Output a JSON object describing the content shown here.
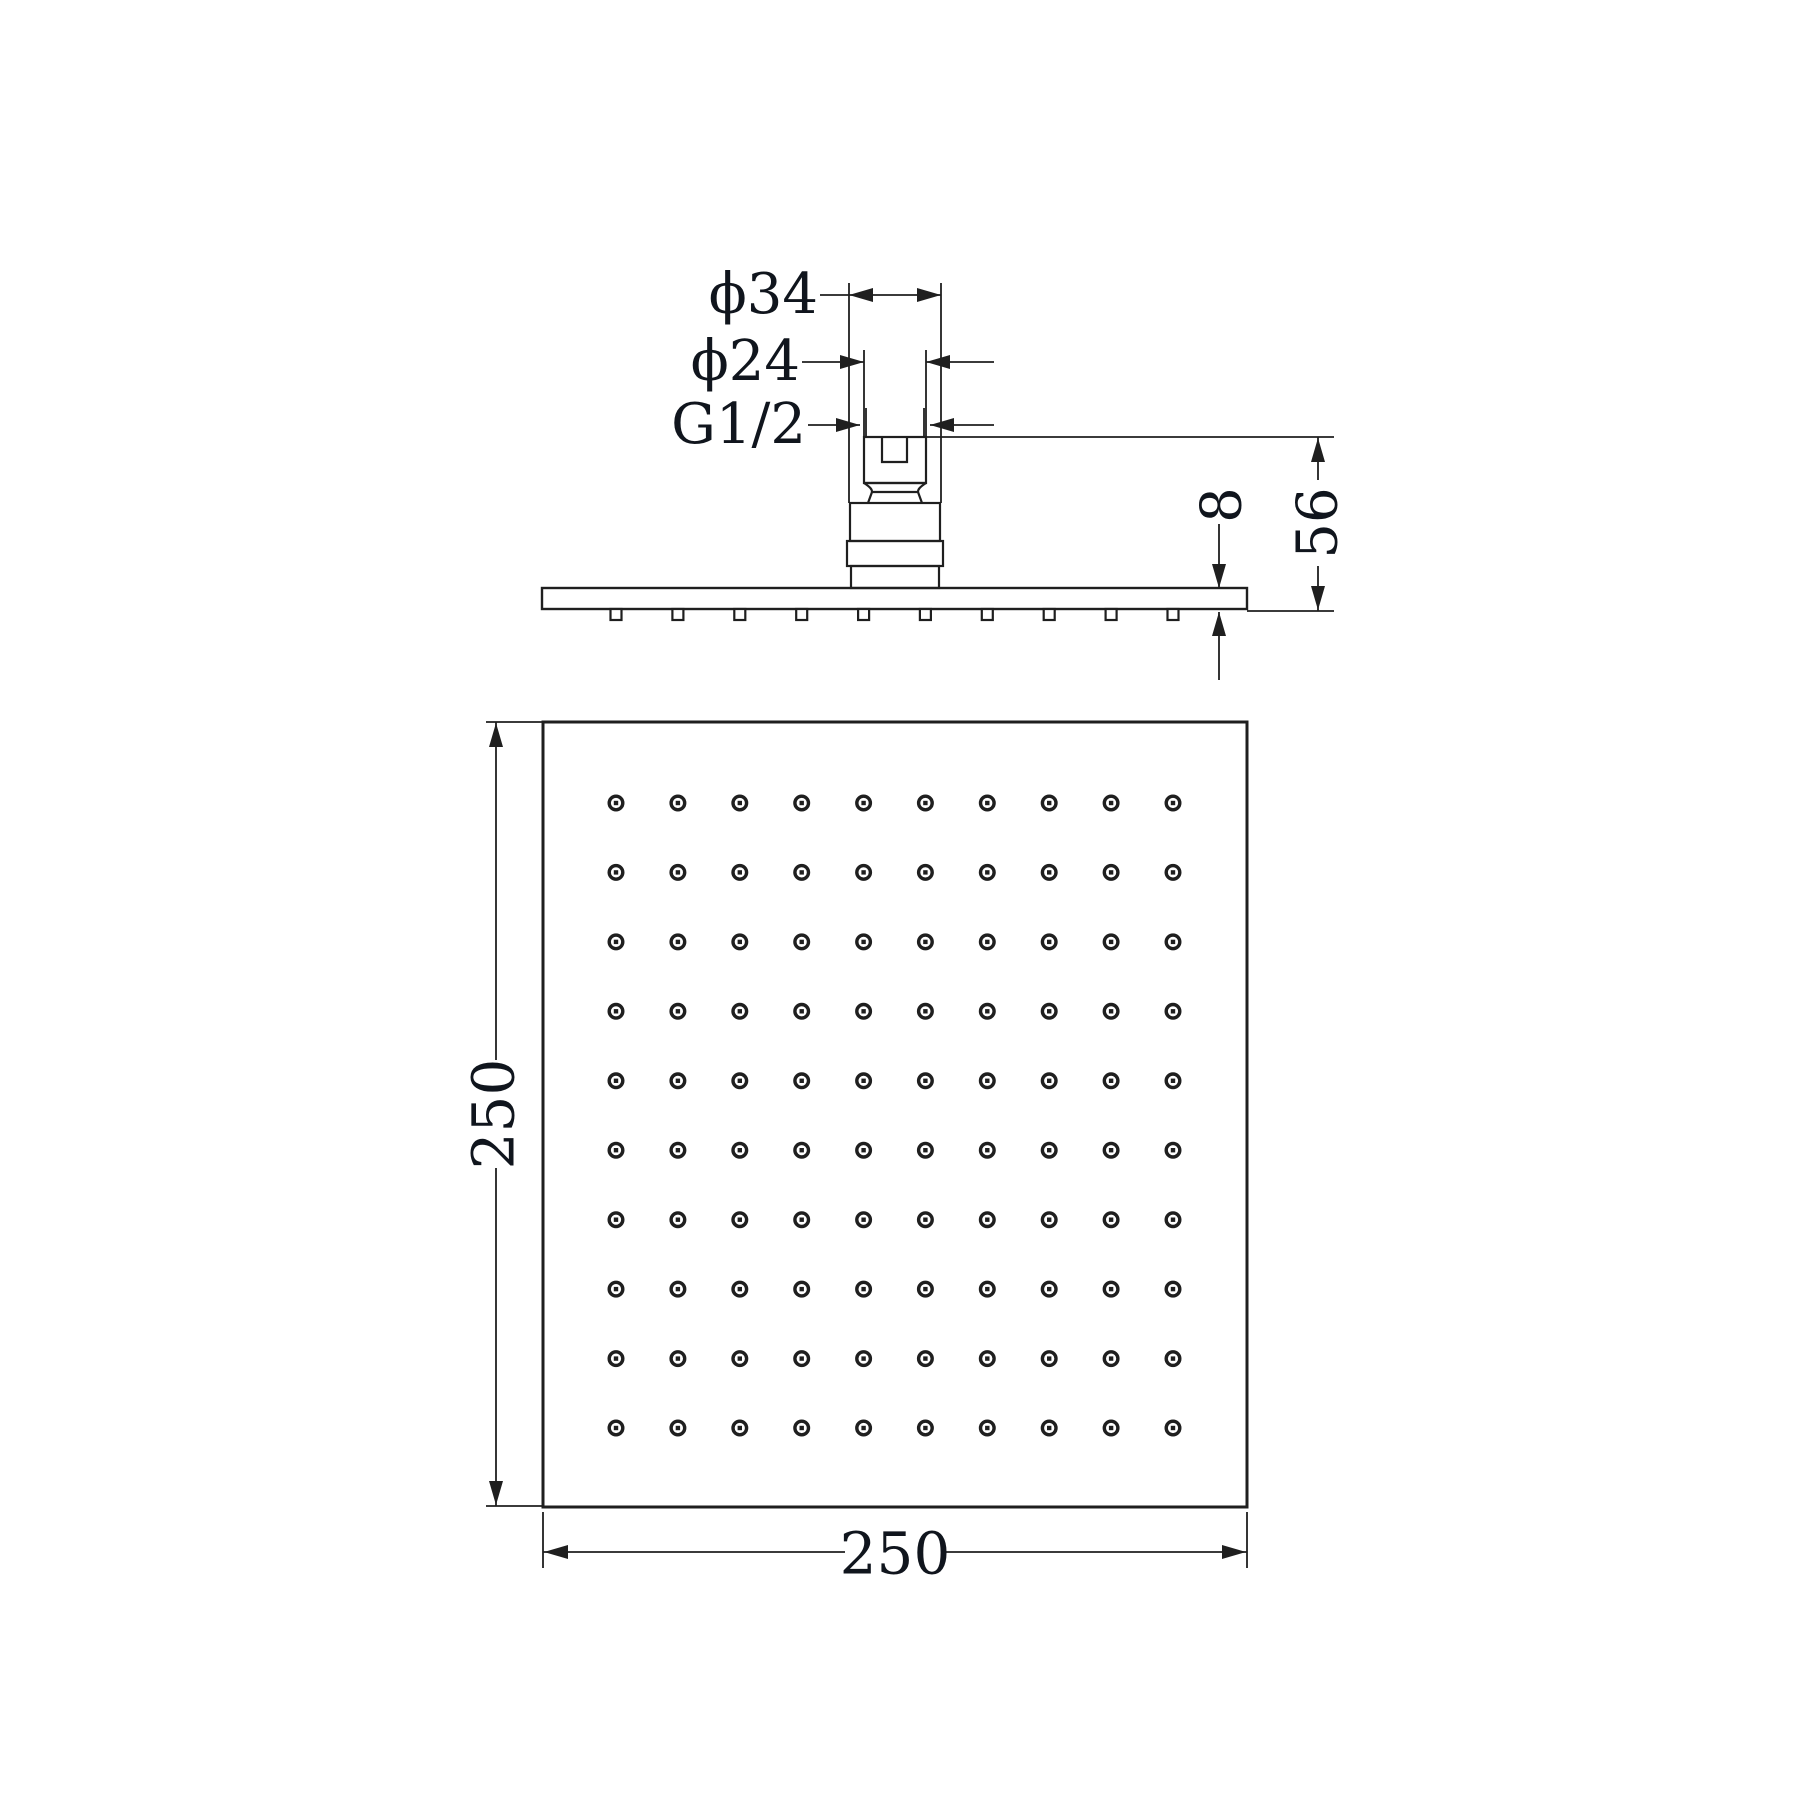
{
  "drawing": {
    "type": "technical-drawing-shower-head",
    "labels": {
      "phi34": "ϕ34",
      "phi24": "ϕ24",
      "thread": "G1/2",
      "plate_thickness": "8",
      "connector_height": "56",
      "width": "250",
      "height": "250"
    },
    "views": {
      "side": {
        "description": "side profile with inlet connector",
        "nozzle_count": 10
      },
      "front": {
        "description": "square face with spray holes",
        "hole_grid": {
          "rows": 10,
          "cols": 10
        }
      }
    },
    "colors": {
      "line": "#1f1f1f",
      "text": "#10151d",
      "background": "#ffffff"
    }
  }
}
